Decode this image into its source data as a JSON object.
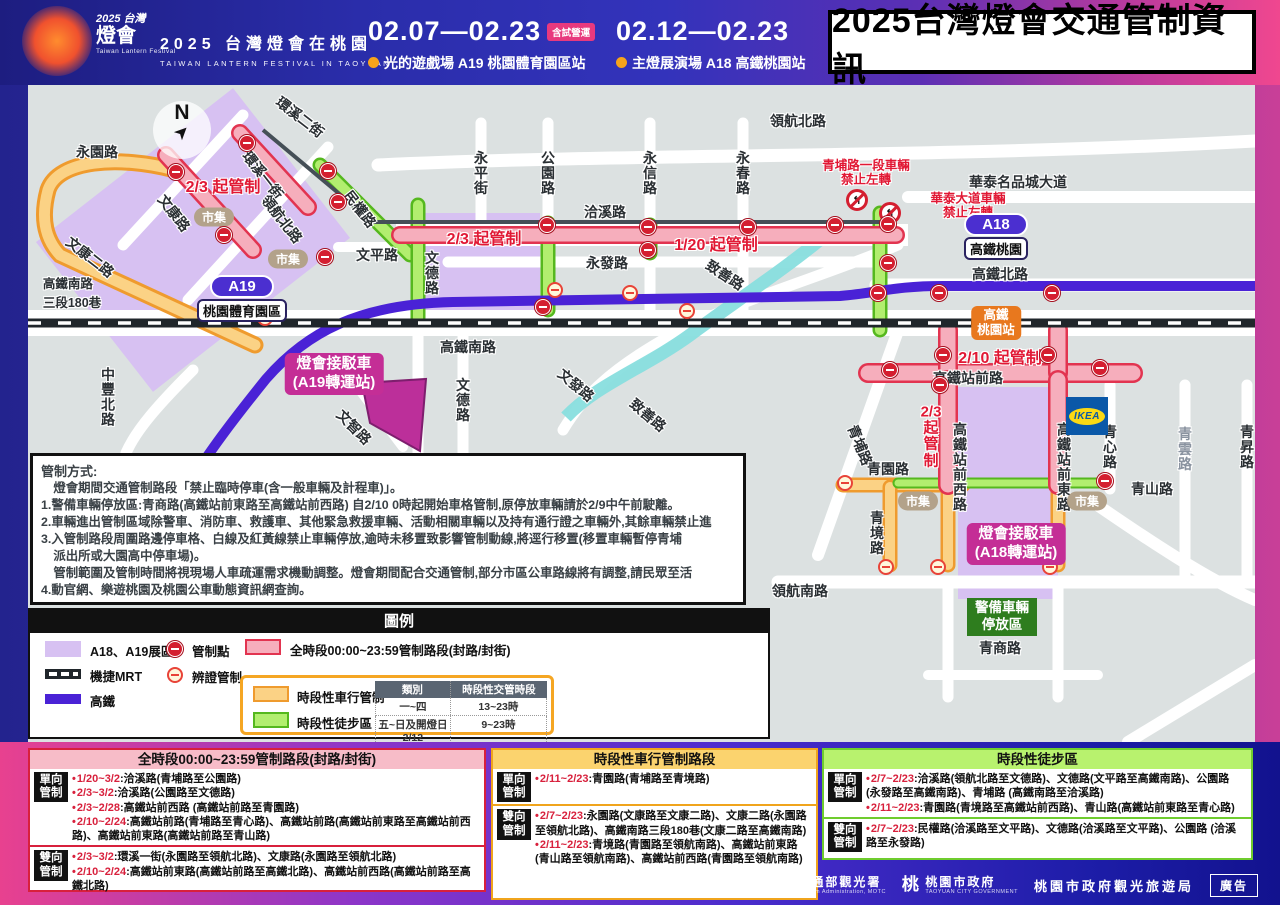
{
  "header": {
    "logo": {
      "year": "2025",
      "place": "台灣",
      "script": "燈會",
      "sub": "Taiwan Lantern Festival"
    },
    "event_cn": "2025 台灣燈會在桃園",
    "event_en": "TAIWAN LANTERN FESTIVAL IN TAOYUAN",
    "period1": {
      "dates": "02.07—02.23",
      "badge": "含試營運",
      "venue": "光的遊戲場  A19 桃園體育園區站"
    },
    "period2": {
      "dates": "02.12—02.23",
      "venue": "主燈展演場  A18 高鐵桃園站"
    },
    "title": "2025台灣燈會交通管制資訊"
  },
  "map": {
    "compass": "N",
    "ikea": "IKEA",
    "road_labels": [
      {
        "t": "永園路",
        "x": 69,
        "y": 67,
        "o": "h"
      },
      {
        "t": "文平路",
        "x": 349,
        "y": 170,
        "o": "h"
      },
      {
        "t": "洽溪路",
        "x": 577,
        "y": 127,
        "o": "h"
      },
      {
        "t": "永發路",
        "x": 579,
        "y": 178,
        "o": "h"
      },
      {
        "t": "領航北路",
        "x": 770,
        "y": 36,
        "o": "h"
      },
      {
        "t": "高鐵南路",
        "x": 440,
        "y": 262,
        "o": "h"
      },
      {
        "t": "華泰名品城大道",
        "x": 990,
        "y": 97,
        "o": "h"
      },
      {
        "t": "高鐵北路",
        "x": 972,
        "y": 189,
        "o": "h"
      },
      {
        "t": "高鐵站前路",
        "x": 940,
        "y": 293,
        "o": "h"
      },
      {
        "t": "青園路",
        "x": 860,
        "y": 384,
        "o": "h"
      },
      {
        "t": "青山路",
        "x": 1124,
        "y": 404,
        "o": "h"
      },
      {
        "t": "領航南路",
        "x": 772,
        "y": 506,
        "o": "h"
      },
      {
        "t": "青商路",
        "x": 972,
        "y": 563,
        "o": "h"
      },
      {
        "t": "高鐵南路\n三段180巷",
        "x": 44,
        "y": 207,
        "o": "h2"
      },
      {
        "t": "永平街",
        "x": 453,
        "y": 88,
        "o": "v"
      },
      {
        "t": "公園路",
        "x": 520,
        "y": 88,
        "o": "v"
      },
      {
        "t": "永信路",
        "x": 622,
        "y": 88,
        "o": "v"
      },
      {
        "t": "永春路",
        "x": 715,
        "y": 88,
        "o": "v"
      },
      {
        "t": "文德路",
        "x": 404,
        "y": 188,
        "o": "v"
      },
      {
        "t": "文德路",
        "x": 435,
        "y": 315,
        "o": "v"
      },
      {
        "t": "中豐北路",
        "x": 80,
        "y": 312,
        "o": "v"
      },
      {
        "t": "青境路",
        "x": 849,
        "y": 448,
        "o": "v"
      },
      {
        "t": "高鐵站前西路",
        "x": 932,
        "y": 382,
        "o": "v"
      },
      {
        "t": "高鐵站前東路",
        "x": 1036,
        "y": 382,
        "o": "v"
      },
      {
        "t": "青心路",
        "x": 1082,
        "y": 362,
        "o": "v"
      },
      {
        "t": "青雲路",
        "x": 1157,
        "y": 364,
        "o": "v",
        "dim": true
      },
      {
        "t": "青昇路",
        "x": 1219,
        "y": 362,
        "o": "v"
      },
      {
        "t": "環溪二街",
        "x": 272,
        "y": 32,
        "o": "d",
        "r": 38
      },
      {
        "t": "環溪一街",
        "x": 235,
        "y": 90,
        "o": "d",
        "r": 52
      },
      {
        "t": "領航北路",
        "x": 254,
        "y": 134,
        "o": "d",
        "r": 52
      },
      {
        "t": "文康路",
        "x": 146,
        "y": 128,
        "o": "d",
        "r": 52
      },
      {
        "t": "文康二路",
        "x": 62,
        "y": 172,
        "o": "d",
        "r": 38
      },
      {
        "t": "民權路",
        "x": 332,
        "y": 124,
        "o": "d",
        "r": 52
      },
      {
        "t": "致善路",
        "x": 697,
        "y": 190,
        "o": "d",
        "r": 33
      },
      {
        "t": "致善路",
        "x": 620,
        "y": 330,
        "o": "d",
        "r": 40
      },
      {
        "t": "文發路",
        "x": 548,
        "y": 300,
        "o": "d",
        "r": 40
      },
      {
        "t": "文智路",
        "x": 326,
        "y": 342,
        "o": "d",
        "r": 45
      },
      {
        "t": "青埔路",
        "x": 832,
        "y": 360,
        "o": "d",
        "r": 68
      }
    ],
    "control_labels": [
      {
        "t": "2/3 起管制",
        "x": 195,
        "y": 100
      },
      {
        "t": "2/3 起管制",
        "x": 456,
        "y": 152
      },
      {
        "t": "1/20 起管制",
        "x": 688,
        "y": 158
      },
      {
        "t": "2/10 起管制",
        "x": 972,
        "y": 271
      },
      {
        "t": "2/3\n起\n管\n制",
        "x": 903,
        "y": 352,
        "v": true
      }
    ],
    "warn_labels": [
      {
        "t": "青埔路一段車輛\n禁止左轉",
        "x": 838,
        "y": 88
      },
      {
        "t": "華泰大道車輛\n禁止左轉",
        "x": 940,
        "y": 121
      }
    ],
    "noleft_icons": [
      {
        "x": 829,
        "y": 115
      },
      {
        "x": 862,
        "y": 128
      }
    ],
    "markets": [
      {
        "t": "市集",
        "x": 186,
        "y": 132
      },
      {
        "t": "市集",
        "x": 260,
        "y": 174
      },
      {
        "t": "市集",
        "x": 890,
        "y": 416
      },
      {
        "t": "市集",
        "x": 1059,
        "y": 416
      }
    ],
    "stations": [
      {
        "id": "A19",
        "name": "桃園體育園區"
      },
      {
        "id": "A18",
        "name": "高鐵桃園"
      }
    ],
    "hsr_station": "高鐵\n桃園站",
    "shuttles": [
      "燈會接駁車\n(A19轉運站)",
      "燈會接駁車\n(A18轉運站)"
    ],
    "police": "警備車輛\n停放區",
    "points": [
      {
        "x": 219,
        "y": 58,
        "t": "r"
      },
      {
        "x": 148,
        "y": 87,
        "t": "r"
      },
      {
        "x": 196,
        "y": 150,
        "t": "r"
      },
      {
        "x": 237,
        "y": 233,
        "t": "y"
      },
      {
        "x": 300,
        "y": 86,
        "t": "r"
      },
      {
        "x": 297,
        "y": 172,
        "t": "r"
      },
      {
        "x": 310,
        "y": 117,
        "t": "r"
      },
      {
        "x": 519,
        "y": 140,
        "t": "r"
      },
      {
        "x": 515,
        "y": 222,
        "t": "r"
      },
      {
        "x": 527,
        "y": 205,
        "t": "y"
      },
      {
        "x": 602,
        "y": 208,
        "t": "y"
      },
      {
        "x": 659,
        "y": 226,
        "t": "y"
      },
      {
        "x": 620,
        "y": 142,
        "t": "r"
      },
      {
        "x": 620,
        "y": 165,
        "t": "r"
      },
      {
        "x": 720,
        "y": 142,
        "t": "r"
      },
      {
        "x": 807,
        "y": 140,
        "t": "r"
      },
      {
        "x": 860,
        "y": 139,
        "t": "r"
      },
      {
        "x": 860,
        "y": 178,
        "t": "r"
      },
      {
        "x": 850,
        "y": 208,
        "t": "r"
      },
      {
        "x": 862,
        "y": 285,
        "t": "r"
      },
      {
        "x": 915,
        "y": 270,
        "t": "r"
      },
      {
        "x": 1020,
        "y": 270,
        "t": "r"
      },
      {
        "x": 1072,
        "y": 283,
        "t": "r"
      },
      {
        "x": 912,
        "y": 300,
        "t": "r"
      },
      {
        "x": 911,
        "y": 208,
        "t": "r"
      },
      {
        "x": 1024,
        "y": 208,
        "t": "r"
      },
      {
        "x": 817,
        "y": 398,
        "t": "y"
      },
      {
        "x": 1077,
        "y": 396,
        "t": "r"
      },
      {
        "x": 858,
        "y": 482,
        "t": "y"
      },
      {
        "x": 910,
        "y": 482,
        "t": "y"
      },
      {
        "x": 1022,
        "y": 482,
        "t": "y"
      }
    ]
  },
  "notice": {
    "title": "管制方式:",
    "lines": [
      "　燈會期間交通管制路段「禁止臨時停車(含一般車輛及計程車)」。",
      "1.警備車輛停放區:青商路(高鐵站前東路至高鐵站前西路) 自2/10 0時起開始車格管制,原停放車輛請於2/9中午前駛離。",
      "2.車輛進出管制區域除警車、消防車、救護車、其他緊急救援車輛、活動相關車輛以及持有通行證之車輛外,其餘車輛禁止進",
      "3.入管制路段周圍路邊停車格、白線及紅黃線禁止車輛停放,逾時未移置致影響管制動線,將逕行移置(移置車輛暫停青埔",
      "　派出所或大園高中停車場)。",
      "　管制範圍及管制時間將視現場人車疏運需求機動調整。燈會期間配合交通管制,部分市區公車路線將有調整,請民眾至活",
      "4.動官網、樂遊桃園及桃園公車動態資訊網查詢。"
    ]
  },
  "legend": {
    "title": "圖例",
    "zone": "A18、A19展區",
    "mrt": "機捷MRT",
    "hsr": "高鐵",
    "point_red": "管制點",
    "point_yellow": "辨證管制",
    "full": "全時段00:00~23:59管制路段(封路/封街)",
    "timed_traffic": "時段性車行管制",
    "timed_walk": "時段性徒步區",
    "table": {
      "headers": [
        "類別",
        "時段性交管時段"
      ],
      "rows": [
        [
          "一~四",
          "13~23時"
        ],
        [
          "五~日及開燈日2/12",
          "9~23時"
        ]
      ]
    }
  },
  "panels": [
    {
      "title": "全時段00:00~23:59管制路段(封路/封街)",
      "groups": [
        {
          "label": "單向\n管制",
          "items": [
            {
              "d": "1/20~3/2",
              "t": ":洽溪路(青埔路至公園路)"
            },
            {
              "d": "2/3~3/2",
              "t": ":洽溪路(公園路至文德路)"
            },
            {
              "d": "2/3~2/28",
              "t": ":高鐵站前西路 (高鐵站前路至青園路)"
            },
            {
              "d": "2/10~2/24",
              "t": ":高鐵站前路(青埔路至青心路)、高鐵站前路(高鐵站前東路至高鐵站前西路)、高鐵站前東路(高鐵站前路至青山路)"
            }
          ]
        },
        {
          "label": "雙向\n管制",
          "items": [
            {
              "d": "2/3~3/2",
              "t": ":環溪一街(永園路至領航北路)、文康路(永園路至領航北路)"
            },
            {
              "d": "2/10~2/24",
              "t": ":高鐵站前東路(高鐵站前路至高鐵北路)、高鐵站前西路(高鐵站前路至高鐵北路)"
            }
          ]
        }
      ]
    },
    {
      "title": "時段性車行管制路段",
      "groups": [
        {
          "label": "單向\n管制",
          "items": [
            {
              "d": "2/11~2/23",
              "t": ":青園路(青埔路至青境路)"
            }
          ]
        },
        {
          "label": "雙向\n管制",
          "items": [
            {
              "d": "2/7~2/23",
              "t": ":永園路(文康路至文康二路)、文康二路(永園路至領航北路)、高鐵南路三段180巷(文康二路至高鐵南路)"
            },
            {
              "d": "2/11~2/23",
              "t": ":青境路(青園路至領航南路)、高鐵站前東路(青山路至領航南路)、高鐵站前西路(青園路至領航南路)"
            }
          ]
        }
      ]
    },
    {
      "title": "時段性徒步區",
      "groups": [
        {
          "label": "單向\n管制",
          "items": [
            {
              "d": "2/7~2/23",
              "t": ":洽溪路(領航北路至文德路)、文德路(文平路至高鐵南路)、公園路 (永發路至高鐵南路)、青埔路 (高鐵南路至洽溪路)"
            },
            {
              "d": "2/11~2/23",
              "t": ":青園路(青境路至高鐵站前西路)、青山路(高鐵站前東路至青心路)"
            }
          ]
        },
        {
          "label": "雙向\n管制",
          "items": [
            {
              "d": "2/7~2/23",
              "t": ":民權路(洽溪路至文平路)、文德路(洽溪路至文平路)、公園路 (洽溪路至永發路)"
            }
          ]
        }
      ]
    }
  ],
  "footer": {
    "taiwan": "TAIWAN",
    "motc": "交通部觀光署",
    "motc_en": "Tourism Administration, MOTC",
    "peach": "桃",
    "city": "桃園市政府",
    "city_en": "TAOYUAN CITY GOVERNMENT",
    "bureau": "桃園市政府觀光旅遊局",
    "ad": "廣告"
  }
}
